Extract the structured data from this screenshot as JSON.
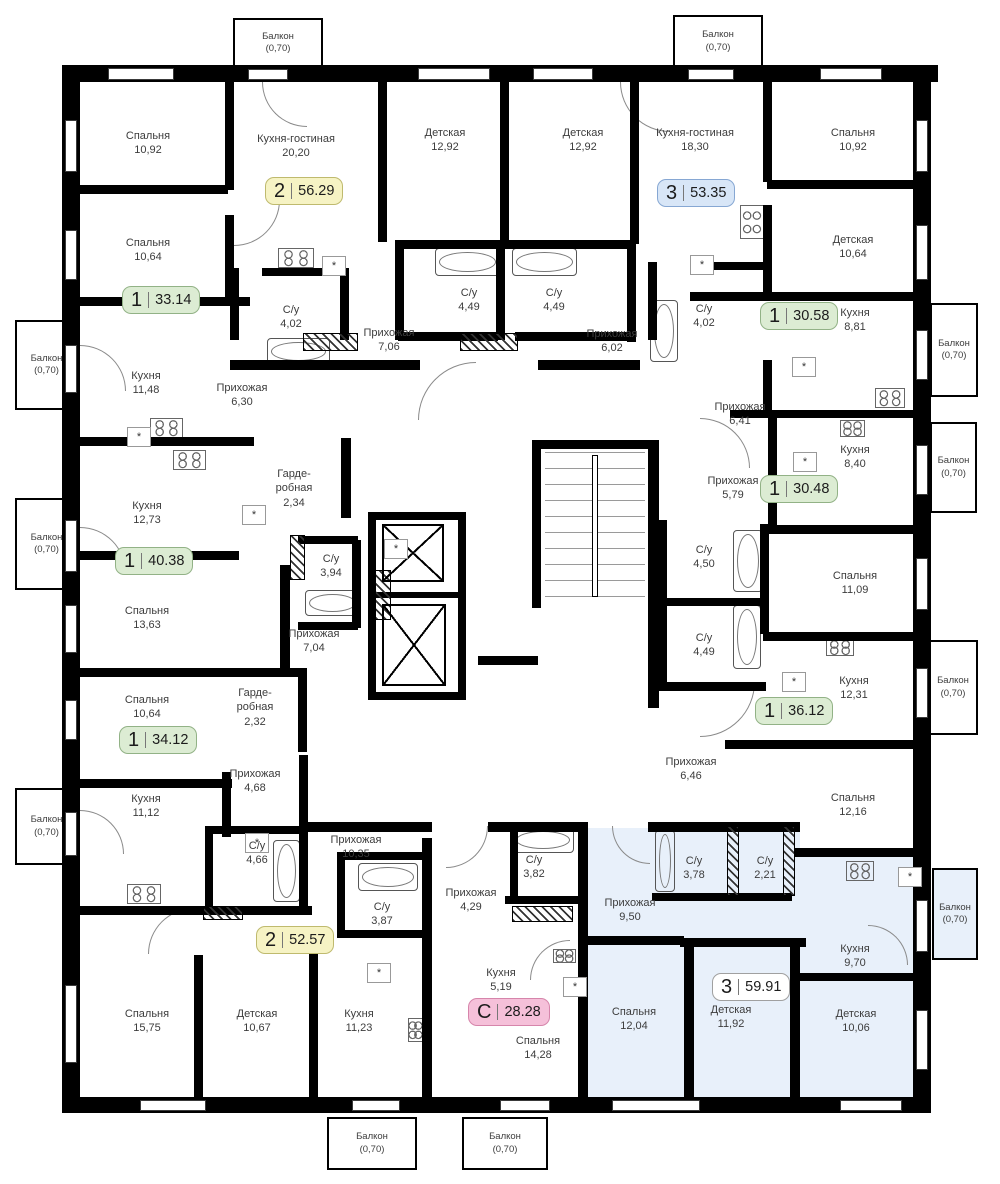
{
  "meta": {
    "type": "residential-floor-plan",
    "highlight_color": "#e8f0fa",
    "wall_color": "#000000",
    "asterisk_symbol": "*"
  },
  "badge_colors": {
    "green": {
      "bg": "#dcecd3",
      "border": "#92b286"
    },
    "yellow": {
      "bg": "#f6f3c4",
      "border": "#bfba6e"
    },
    "blue": {
      "bg": "#d8e6f7",
      "border": "#86a7d3"
    },
    "pink": {
      "bg": "#f5c0d9",
      "border": "#d685ab"
    },
    "white": {
      "bg": "#ffffff",
      "border": "#a0a0a0"
    }
  },
  "badges": [
    {
      "num": "2",
      "area": "56.29",
      "color": "yellow",
      "x": 302,
      "y": 191
    },
    {
      "num": "3",
      "area": "53.35",
      "color": "blue",
      "x": 694,
      "y": 193
    },
    {
      "num": "1",
      "area": "33.14",
      "color": "green",
      "x": 159,
      "y": 300
    },
    {
      "num": "1",
      "area": "30.58",
      "color": "green",
      "x": 797,
      "y": 316
    },
    {
      "num": "1",
      "area": "30.48",
      "color": "green",
      "x": 797,
      "y": 489
    },
    {
      "num": "1",
      "area": "40.38",
      "color": "green",
      "x": 152,
      "y": 561
    },
    {
      "num": "1",
      "area": "36.12",
      "color": "green",
      "x": 792,
      "y": 711
    },
    {
      "num": "1",
      "area": "34.12",
      "color": "green",
      "x": 156,
      "y": 740
    },
    {
      "num": "2",
      "area": "52.57",
      "color": "yellow",
      "x": 293,
      "y": 940
    },
    {
      "num": "С",
      "area": "28.28",
      "color": "pink",
      "x": 505,
      "y": 1012
    },
    {
      "num": "3",
      "area": "59.91",
      "color": "white",
      "x": 749,
      "y": 987
    }
  ],
  "rooms": [
    {
      "label": "Спальня",
      "area": "10,92",
      "x": 148,
      "y": 143
    },
    {
      "label": "Кухня-гостиная",
      "area": "20,20",
      "x": 296,
      "y": 146
    },
    {
      "label": "Детская",
      "area": "12,92",
      "x": 445,
      "y": 140
    },
    {
      "label": "Детская",
      "area": "12,92",
      "x": 583,
      "y": 140
    },
    {
      "label": "Кухня-гостиная",
      "area": "18,30",
      "x": 695,
      "y": 140
    },
    {
      "label": "Спальня",
      "area": "10,92",
      "x": 853,
      "y": 140
    },
    {
      "label": "Спальня",
      "area": "10,64",
      "x": 148,
      "y": 250
    },
    {
      "label": "Детская",
      "area": "10,64",
      "x": 853,
      "y": 247
    },
    {
      "label": "С/у",
      "area": "4,02",
      "x": 291,
      "y": 317
    },
    {
      "label": "С/у",
      "area": "4,49",
      "x": 469,
      "y": 300
    },
    {
      "label": "С/у",
      "area": "4,49",
      "x": 554,
      "y": 300
    },
    {
      "label": "С/у",
      "area": "4,02",
      "x": 704,
      "y": 316
    },
    {
      "label": "Кухня",
      "area": "8,81",
      "x": 855,
      "y": 320
    },
    {
      "label": "Прихожая",
      "area": "7,06",
      "x": 389,
      "y": 340
    },
    {
      "label": "Прихожая",
      "area": "6,02",
      "x": 612,
      "y": 341
    },
    {
      "label": "Кухня",
      "area": "11,48",
      "x": 146,
      "y": 383
    },
    {
      "label": "Прихожая",
      "area": "6,30",
      "x": 242,
      "y": 395
    },
    {
      "label": "Прихожая",
      "area": "6,41",
      "x": 740,
      "y": 414
    },
    {
      "label": "Кухня",
      "area": "8,40",
      "x": 855,
      "y": 457
    },
    {
      "label": "Кухня",
      "area": "12,73",
      "x": 147,
      "y": 513
    },
    {
      "label": "Гарде- робная",
      "area": "2,34",
      "x": 294,
      "y": 481,
      "w": 58
    },
    {
      "label": "Прихожая",
      "area": "5,79",
      "x": 733,
      "y": 488
    },
    {
      "label": "С/у",
      "area": "3,94",
      "x": 331,
      "y": 566
    },
    {
      "label": "Спальня",
      "area": "13,63",
      "x": 147,
      "y": 618
    },
    {
      "label": "С/у",
      "area": "4,50",
      "x": 704,
      "y": 557
    },
    {
      "label": "Спальня",
      "area": "11,09",
      "x": 855,
      "y": 583
    },
    {
      "label": "Прихожая",
      "area": "7,04",
      "x": 314,
      "y": 641
    },
    {
      "label": "С/у",
      "area": "4,49",
      "x": 704,
      "y": 645
    },
    {
      "label": "Кухня",
      "area": "12,31",
      "x": 854,
      "y": 688
    },
    {
      "label": "Спальня",
      "area": "10,64",
      "x": 147,
      "y": 707
    },
    {
      "label": "Гарде- робная",
      "area": "2,32",
      "x": 255,
      "y": 700,
      "w": 58
    },
    {
      "label": "Прихожая",
      "area": "6,46",
      "x": 691,
      "y": 769
    },
    {
      "label": "Спальня",
      "area": "12,16",
      "x": 853,
      "y": 805
    },
    {
      "label": "Прихожая",
      "area": "4,68",
      "x": 255,
      "y": 781
    },
    {
      "label": "Кухня",
      "area": "11,12",
      "x": 146,
      "y": 806
    },
    {
      "label": "С/у",
      "area": "4,66",
      "x": 257,
      "y": 853
    },
    {
      "label": "Прихожая",
      "area": "10,35",
      "x": 356,
      "y": 847
    },
    {
      "label": "С/у",
      "area": "3,87",
      "x": 382,
      "y": 914
    },
    {
      "label": "Прихожая",
      "area": "4,29",
      "x": 471,
      "y": 900
    },
    {
      "label": "С/у",
      "area": "3,82",
      "x": 534,
      "y": 867
    },
    {
      "label": "Прихожая",
      "area": "9,50",
      "x": 630,
      "y": 910
    },
    {
      "label": "С/у",
      "area": "3,78",
      "x": 694,
      "y": 868
    },
    {
      "label": "С/у",
      "area": "2,21",
      "x": 765,
      "y": 868
    },
    {
      "label": "Кухня",
      "area": "9,70",
      "x": 855,
      "y": 956
    },
    {
      "label": "Кухня",
      "area": "5,19",
      "x": 501,
      "y": 980
    },
    {
      "label": "Спальня",
      "area": "15,75",
      "x": 147,
      "y": 1021
    },
    {
      "label": "Детская",
      "area": "10,67",
      "x": 257,
      "y": 1021
    },
    {
      "label": "Кухня",
      "area": "11,23",
      "x": 359,
      "y": 1021
    },
    {
      "label": "Спальня",
      "area": "14,28",
      "x": 538,
      "y": 1048
    },
    {
      "label": "Спальня",
      "area": "12,04",
      "x": 634,
      "y": 1019
    },
    {
      "label": "Детская",
      "area": "11,92",
      "x": 731,
      "y": 1017
    },
    {
      "label": "Детская",
      "area": "10,06",
      "x": 856,
      "y": 1021
    }
  ],
  "balconies": [
    {
      "label": "Балкон",
      "area": "2,34",
      "coef": "(0,70)",
      "x": 233,
      "y": 18,
      "w": 90,
      "h": 50
    },
    {
      "label": "Балкон",
      "area": "2,34",
      "coef": "(0,70)",
      "x": 673,
      "y": 15,
      "w": 90,
      "h": 53
    },
    {
      "label": "Балкон",
      "area": "2,34",
      "coef": "(0,70)",
      "x": 15,
      "y": 320,
      "w": 63,
      "h": 90
    },
    {
      "label": "Балкон",
      "area": "2,34",
      "coef": "(0,70)",
      "x": 15,
      "y": 498,
      "w": 63,
      "h": 92
    },
    {
      "label": "Балкон",
      "area": "2,34",
      "coef": "(0,70)",
      "x": 15,
      "y": 788,
      "w": 63,
      "h": 77
    },
    {
      "label": "Балкон",
      "area": "2,34",
      "coef": "(0,70)",
      "x": 930,
      "y": 303,
      "w": 48,
      "h": 94
    },
    {
      "label": "Балкон",
      "area": "2,34",
      "coef": "(0,70)",
      "x": 930,
      "y": 422,
      "w": 47,
      "h": 91
    },
    {
      "label": "Балкон",
      "area": "2,34",
      "coef": "(0,70)",
      "x": 928,
      "y": 640,
      "w": 50,
      "h": 95
    },
    {
      "label": "Балкон",
      "area": "2,34",
      "coef": "(0,70)",
      "x": 932,
      "y": 868,
      "w": 46,
      "h": 92,
      "highlight": true
    },
    {
      "label": "Балкон",
      "area": "2,34",
      "coef": "(0,70)",
      "x": 327,
      "y": 1117,
      "w": 90,
      "h": 53
    },
    {
      "label": "Балкон",
      "area": "2,34",
      "coef": "(0,70)",
      "x": 462,
      "y": 1117,
      "w": 86,
      "h": 53
    }
  ]
}
